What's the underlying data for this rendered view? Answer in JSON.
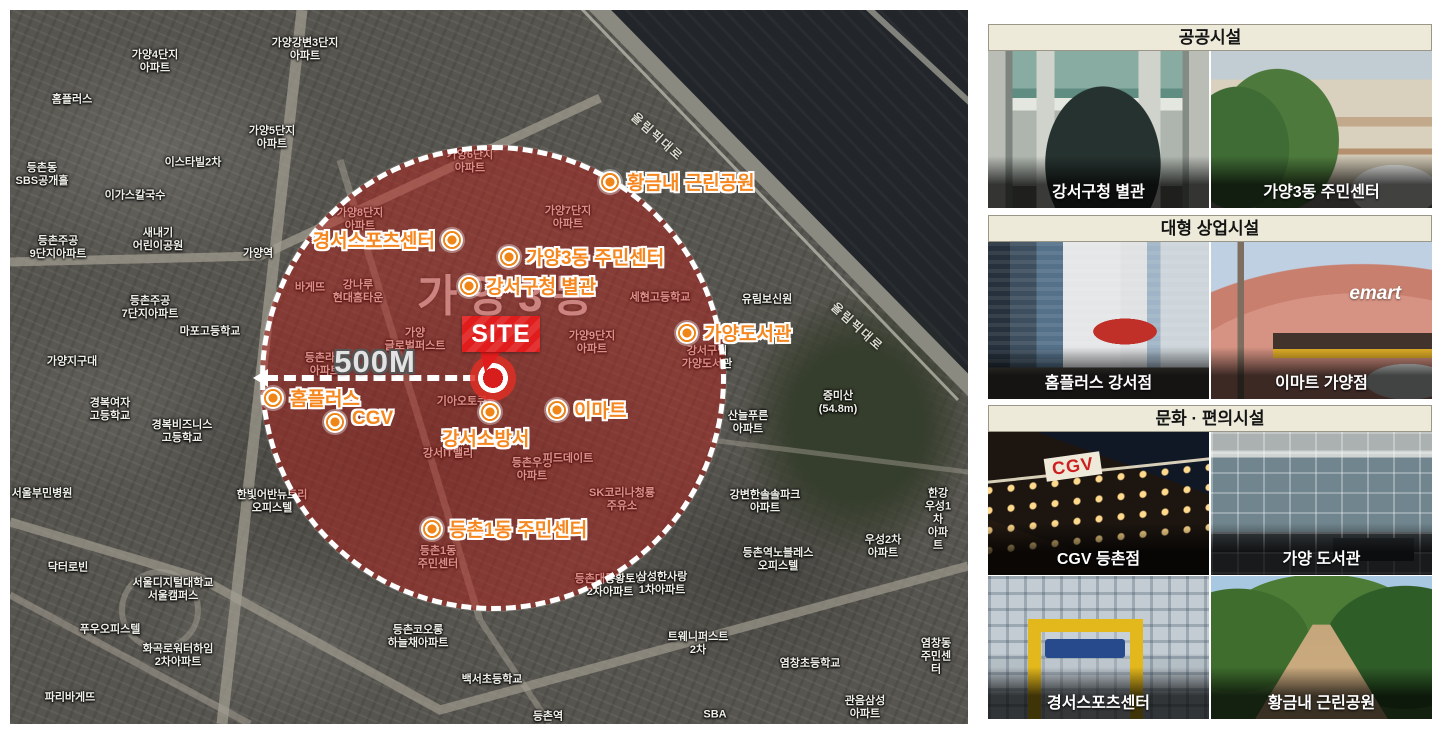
{
  "map": {
    "site": {
      "flag_label": "SITE"
    },
    "radius": {
      "label": "500M"
    },
    "area_label": "가양3동",
    "road_labels": [
      {
        "text": "올림픽대로",
        "x": 615,
        "y": 118,
        "rot": 42
      },
      {
        "text": "올림픽대로",
        "x": 815,
        "y": 308,
        "rot": 42
      }
    ],
    "facilities": [
      {
        "name": "황금내 근린공원",
        "mx": 600,
        "my": 172,
        "side": "right"
      },
      {
        "name": "경서스포츠센터",
        "mx": 442,
        "my": 230,
        "side": "left"
      },
      {
        "name": "가양3동 주민센터",
        "mx": 499,
        "my": 247,
        "side": "right"
      },
      {
        "name": "강서구청 별관",
        "mx": 459,
        "my": 276,
        "side": "right"
      },
      {
        "name": "가양도서관",
        "mx": 677,
        "my": 323,
        "side": "right"
      },
      {
        "name": "홈플러스",
        "mx": 263,
        "my": 388,
        "side": "right"
      },
      {
        "name": "CGV",
        "mx": 325,
        "my": 412,
        "side": "right"
      },
      {
        "name": "이마트",
        "mx": 547,
        "my": 400,
        "side": "right"
      },
      {
        "name": "강서소방서",
        "mx": 480,
        "my": 402,
        "side": "below"
      },
      {
        "name": "등촌1동 주민센터",
        "mx": 422,
        "my": 519,
        "side": "right"
      }
    ],
    "background_labels": [
      {
        "t": "가양4단지\n아파트",
        "x": 145,
        "y": 52
      },
      {
        "t": "가양강변3단지\n아파트",
        "x": 295,
        "y": 40
      },
      {
        "t": "홈플러스",
        "x": 62,
        "y": 90
      },
      {
        "t": "가양5단지\n아파트",
        "x": 262,
        "y": 128
      },
      {
        "t": "이스타빌2차",
        "x": 183,
        "y": 153
      },
      {
        "t": "등촌동\nSBS공개홀",
        "x": 32,
        "y": 165
      },
      {
        "t": "이가스칼국수",
        "x": 125,
        "y": 186
      },
      {
        "t": "등촌주공\n9단지아파트",
        "x": 48,
        "y": 238
      },
      {
        "t": "새내기\n어린이공원",
        "x": 148,
        "y": 230
      },
      {
        "t": "가양역",
        "x": 248,
        "y": 244
      },
      {
        "t": "등촌주공\n7단지아파트",
        "x": 140,
        "y": 298
      },
      {
        "t": "마포고등학교",
        "x": 200,
        "y": 322
      },
      {
        "t": "가양지구대",
        "x": 62,
        "y": 352
      },
      {
        "t": "경복여자\n고등학교",
        "x": 100,
        "y": 400
      },
      {
        "t": "경복비즈니스\n고등학교",
        "x": 172,
        "y": 422
      },
      {
        "t": "서울부민병원",
        "x": 32,
        "y": 484
      },
      {
        "t": "한빛어반뉴트리\n오피스텔",
        "x": 262,
        "y": 492
      },
      {
        "t": "닥터로빈",
        "x": 58,
        "y": 558
      },
      {
        "t": "서울디지털대학교\n서울캠퍼스",
        "x": 163,
        "y": 580
      },
      {
        "t": "푸우오피스텔",
        "x": 100,
        "y": 620
      },
      {
        "t": "화곡로워터하임\n2차아파트",
        "x": 168,
        "y": 646
      },
      {
        "t": "파리바게뜨",
        "x": 60,
        "y": 688
      },
      {
        "t": "바게뜨",
        "x": 300,
        "y": 278
      },
      {
        "t": "가양6단지\n아파트",
        "x": 460,
        "y": 152
      },
      {
        "t": "가양8단지\n아파트",
        "x": 350,
        "y": 210
      },
      {
        "t": "가양7단지\n아파트",
        "x": 558,
        "y": 208
      },
      {
        "t": "강나루\n현대홈타운",
        "x": 348,
        "y": 282
      },
      {
        "t": "가양\n글로벌퍼스트",
        "x": 405,
        "y": 330
      },
      {
        "t": "등촌라인\n아파트",
        "x": 315,
        "y": 355
      },
      {
        "t": "기아오토큐",
        "x": 452,
        "y": 392
      },
      {
        "t": "가양9단지\n아파트",
        "x": 582,
        "y": 333
      },
      {
        "t": "세현고등학교",
        "x": 650,
        "y": 288
      },
      {
        "t": "강서구립\n가양도서관",
        "x": 697,
        "y": 348
      },
      {
        "t": "유림보신원",
        "x": 757,
        "y": 290
      },
      {
        "t": "강서IT밸리",
        "x": 438,
        "y": 444
      },
      {
        "t": "등촌우성\n아파트",
        "x": 522,
        "y": 460
      },
      {
        "t": "피드데이트",
        "x": 558,
        "y": 449
      },
      {
        "t": "SK코리나청룡\n주유소",
        "x": 612,
        "y": 490
      },
      {
        "t": "등촌1동\n주민센터",
        "x": 428,
        "y": 548
      },
      {
        "t": "등촌대동황토방\n2차아파트",
        "x": 600,
        "y": 576
      },
      {
        "t": "증미산\n(54.8m)",
        "x": 828,
        "y": 393
      },
      {
        "t": "산늘푸른\n아파트",
        "x": 738,
        "y": 413
      },
      {
        "t": "강변한솔솔파크\n아파트",
        "x": 755,
        "y": 492
      },
      {
        "t": "한강우성1차\n아파트",
        "x": 928,
        "y": 510
      },
      {
        "t": "우성2차\n아파트",
        "x": 873,
        "y": 537
      },
      {
        "t": "등촌역노블레스\n오피스텔",
        "x": 768,
        "y": 550
      },
      {
        "t": "삼성한사랑\n1차아파트",
        "x": 652,
        "y": 574
      },
      {
        "t": "등촌코오롱\n하늘채아파트",
        "x": 408,
        "y": 627
      },
      {
        "t": "트웨니퍼스트\n2차",
        "x": 688,
        "y": 634
      },
      {
        "t": "백서초등학교",
        "x": 482,
        "y": 670
      },
      {
        "t": "염창초등학교",
        "x": 800,
        "y": 654
      },
      {
        "t": "염창동\n주민센터",
        "x": 926,
        "y": 647
      },
      {
        "t": "관음삼성\n아파트",
        "x": 855,
        "y": 698
      },
      {
        "t": "SBA",
        "x": 705,
        "y": 705
      },
      {
        "t": "등촌역",
        "x": 538,
        "y": 707
      }
    ]
  },
  "sidebar": {
    "sections": [
      {
        "title": "공공시설",
        "photos": [
          {
            "caption": "강서구청 별관",
            "art": "annex"
          },
          {
            "caption": "가양3동 주민센터",
            "art": "community"
          }
        ]
      },
      {
        "title": "대형 상업시설",
        "photos": [
          {
            "caption": "홈플러스 강서점",
            "art": "homeplus"
          },
          {
            "caption": "이마트 가양점",
            "art": "emart",
            "sign": "emart"
          }
        ]
      },
      {
        "title": "문화 · 편의시설",
        "photos": [
          {
            "caption": "CGV 등촌점",
            "art": "cgv",
            "sign": "CGV"
          },
          {
            "caption": "가양 도서관",
            "art": "library"
          },
          {
            "caption": "경서스포츠센터",
            "art": "sports"
          },
          {
            "caption": "황금내 근린공원",
            "art": "park"
          }
        ]
      }
    ]
  },
  "colors": {
    "accent_orange": "#f6871f",
    "site_red": "#e01c1c",
    "circle_fill": "rgba(189,33,27,0.5)",
    "header_bg": "#edead9",
    "river": "#22262a"
  }
}
